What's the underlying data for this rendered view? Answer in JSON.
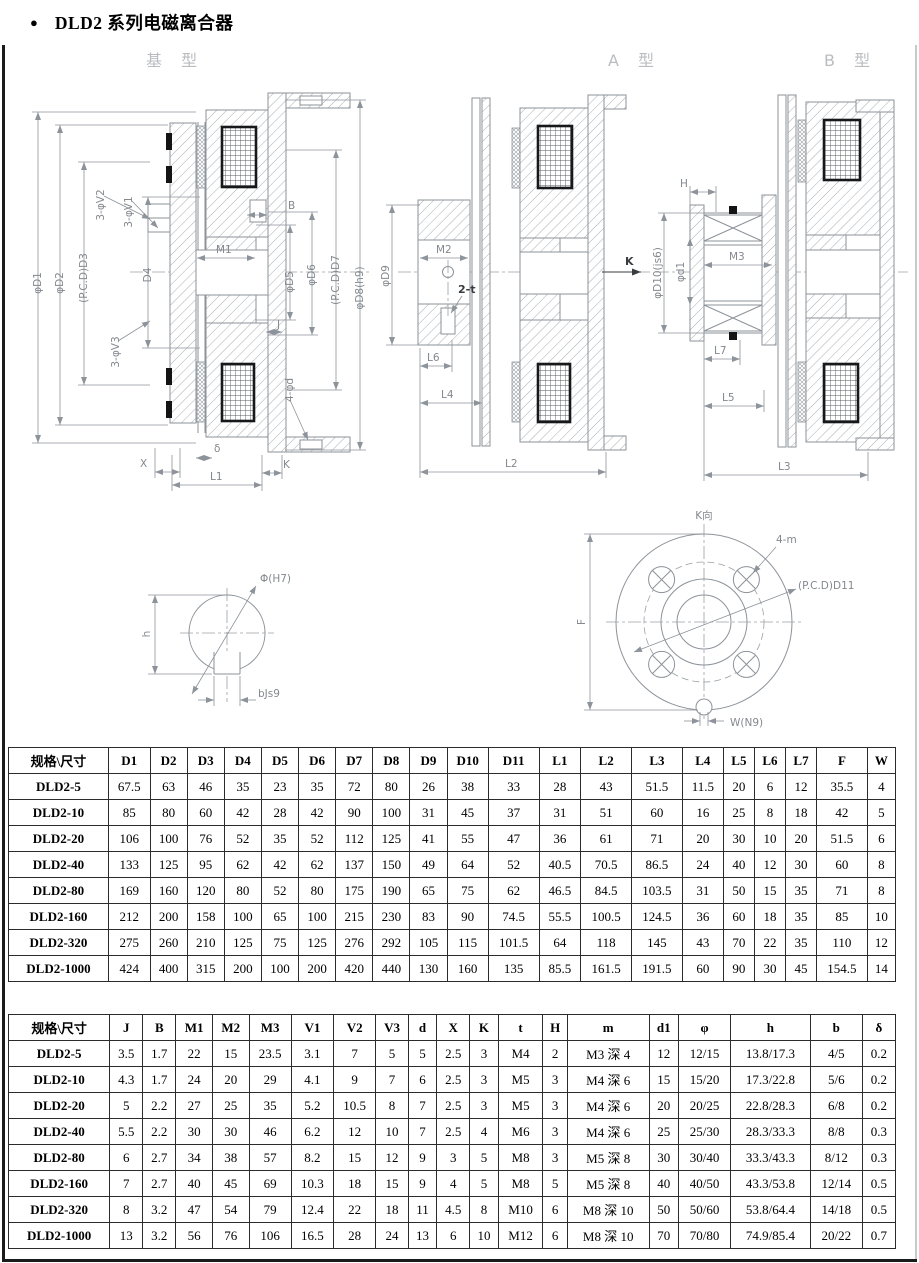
{
  "page": {
    "bullet": "●",
    "title": "DLD2 系列电磁离合器"
  },
  "drawings": {
    "captions": {
      "base": "基 型",
      "a": "A 型",
      "b": "B 型"
    },
    "base": {
      "d1": "φD1",
      "d2": "φD2",
      "d3": "(P.C.D)D3",
      "d4": "D4",
      "v2": "3-φV2",
      "v1": "3-φV1",
      "v3": "3-φV3",
      "b": "B",
      "m1": "M1",
      "j": "J",
      "d5": "φD5",
      "d6": "φD6",
      "d7": "(P.C.D)D7",
      "d8": "φD8(h9)",
      "fourd": "4-φd",
      "x": "X",
      "delta": "δ",
      "l1": "L1",
      "k": "K"
    },
    "a": {
      "d9": "φD9",
      "m2": "M2",
      "t2": "2-t",
      "l6": "L6",
      "l4": "L4",
      "l2": "L2",
      "k": "K"
    },
    "b": {
      "h": "H",
      "d10": "φD10(js6)",
      "d1s": "φd1",
      "m3": "M3",
      "l7": "L7",
      "l5": "L5",
      "l3": "L3"
    },
    "bore": {
      "phi": "Φ(H7)",
      "h": "h",
      "b": "bJs9"
    },
    "flange": {
      "kdir": "K向",
      "m": "4-m",
      "pcd": "(P.C.D)D11",
      "f": "F",
      "w": "W(N9)"
    }
  },
  "table1": {
    "headers": [
      "规格\\尺寸",
      "D1",
      "D2",
      "D3",
      "D4",
      "D5",
      "D6",
      "D7",
      "D8",
      "D9",
      "D10",
      "D11",
      "L1",
      "L2",
      "L3",
      "L4",
      "L5",
      "L6",
      "L7",
      "F",
      "W"
    ],
    "rows": [
      [
        "DLD2-5",
        "67.5",
        "63",
        "46",
        "35",
        "23",
        "35",
        "72",
        "80",
        "26",
        "38",
        "33",
        "28",
        "43",
        "51.5",
        "11.5",
        "20",
        "6",
        "12",
        "35.5",
        "4"
      ],
      [
        "DLD2-10",
        "85",
        "80",
        "60",
        "42",
        "28",
        "42",
        "90",
        "100",
        "31",
        "45",
        "37",
        "31",
        "51",
        "60",
        "16",
        "25",
        "8",
        "18",
        "42",
        "5"
      ],
      [
        "DLD2-20",
        "106",
        "100",
        "76",
        "52",
        "35",
        "52",
        "112",
        "125",
        "41",
        "55",
        "47",
        "36",
        "61",
        "71",
        "20",
        "30",
        "10",
        "20",
        "51.5",
        "6"
      ],
      [
        "DLD2-40",
        "133",
        "125",
        "95",
        "62",
        "42",
        "62",
        "137",
        "150",
        "49",
        "64",
        "52",
        "40.5",
        "70.5",
        "86.5",
        "24",
        "40",
        "12",
        "30",
        "60",
        "8"
      ],
      [
        "DLD2-80",
        "169",
        "160",
        "120",
        "80",
        "52",
        "80",
        "175",
        "190",
        "65",
        "75",
        "62",
        "46.5",
        "84.5",
        "103.5",
        "31",
        "50",
        "15",
        "35",
        "71",
        "8"
      ],
      [
        "DLD2-160",
        "212",
        "200",
        "158",
        "100",
        "65",
        "100",
        "215",
        "230",
        "83",
        "90",
        "74.5",
        "55.5",
        "100.5",
        "124.5",
        "36",
        "60",
        "18",
        "35",
        "85",
        "10"
      ],
      [
        "DLD2-320",
        "275",
        "260",
        "210",
        "125",
        "75",
        "125",
        "276",
        "292",
        "105",
        "115",
        "101.5",
        "64",
        "118",
        "145",
        "43",
        "70",
        "22",
        "35",
        "110",
        "12"
      ],
      [
        "DLD2-1000",
        "424",
        "400",
        "315",
        "200",
        "100",
        "200",
        "420",
        "440",
        "130",
        "160",
        "135",
        "85.5",
        "161.5",
        "191.5",
        "60",
        "90",
        "30",
        "45",
        "154.5",
        "14"
      ]
    ]
  },
  "table2": {
    "headers": [
      "规格\\尺寸",
      "J",
      "B",
      "M1",
      "M2",
      "M3",
      "V1",
      "V2",
      "V3",
      "d",
      "X",
      "K",
      "t",
      "H",
      "m",
      "d1",
      "φ",
      "h",
      "b",
      "δ"
    ],
    "rows": [
      [
        "DLD2-5",
        "3.5",
        "1.7",
        "22",
        "15",
        "23.5",
        "3.1",
        "7",
        "5",
        "5",
        "2.5",
        "3",
        "M4",
        "2",
        "M3 深 4",
        "12",
        "12/15",
        "13.8/17.3",
        "4/5",
        "0.2"
      ],
      [
        "DLD2-10",
        "4.3",
        "1.7",
        "24",
        "20",
        "29",
        "4.1",
        "9",
        "7",
        "6",
        "2.5",
        "3",
        "M5",
        "3",
        "M4 深 6",
        "15",
        "15/20",
        "17.3/22.8",
        "5/6",
        "0.2"
      ],
      [
        "DLD2-20",
        "5",
        "2.2",
        "27",
        "25",
        "35",
        "5.2",
        "10.5",
        "8",
        "7",
        "2.5",
        "3",
        "M5",
        "3",
        "M4 深 6",
        "20",
        "20/25",
        "22.8/28.3",
        "6/8",
        "0.2"
      ],
      [
        "DLD2-40",
        "5.5",
        "2.2",
        "30",
        "30",
        "46",
        "6.2",
        "12",
        "10",
        "7",
        "2.5",
        "4",
        "M6",
        "3",
        "M4 深 6",
        "25",
        "25/30",
        "28.3/33.3",
        "8/8",
        "0.3"
      ],
      [
        "DLD2-80",
        "6",
        "2.7",
        "34",
        "38",
        "57",
        "8.2",
        "15",
        "12",
        "9",
        "3",
        "5",
        "M8",
        "3",
        "M5 深 8",
        "30",
        "30/40",
        "33.3/43.3",
        "8/12",
        "0.3"
      ],
      [
        "DLD2-160",
        "7",
        "2.7",
        "40",
        "45",
        "69",
        "10.3",
        "18",
        "15",
        "9",
        "4",
        "5",
        "M8",
        "5",
        "M5 深 8",
        "40",
        "40/50",
        "43.3/53.8",
        "12/14",
        "0.5"
      ],
      [
        "DLD2-320",
        "8",
        "3.2",
        "47",
        "54",
        "79",
        "12.4",
        "22",
        "18",
        "11",
        "4.5",
        "8",
        "M10",
        "6",
        "M8 深 10",
        "50",
        "50/60",
        "53.8/64.4",
        "14/18",
        "0.5"
      ],
      [
        "DLD2-1000",
        "13",
        "3.2",
        "56",
        "76",
        "106",
        "16.5",
        "28",
        "24",
        "13",
        "6",
        "10",
        "M12",
        "6",
        "M8 深 10",
        "70",
        "70/80",
        "74.9/85.4",
        "20/22",
        "0.7"
      ]
    ]
  }
}
